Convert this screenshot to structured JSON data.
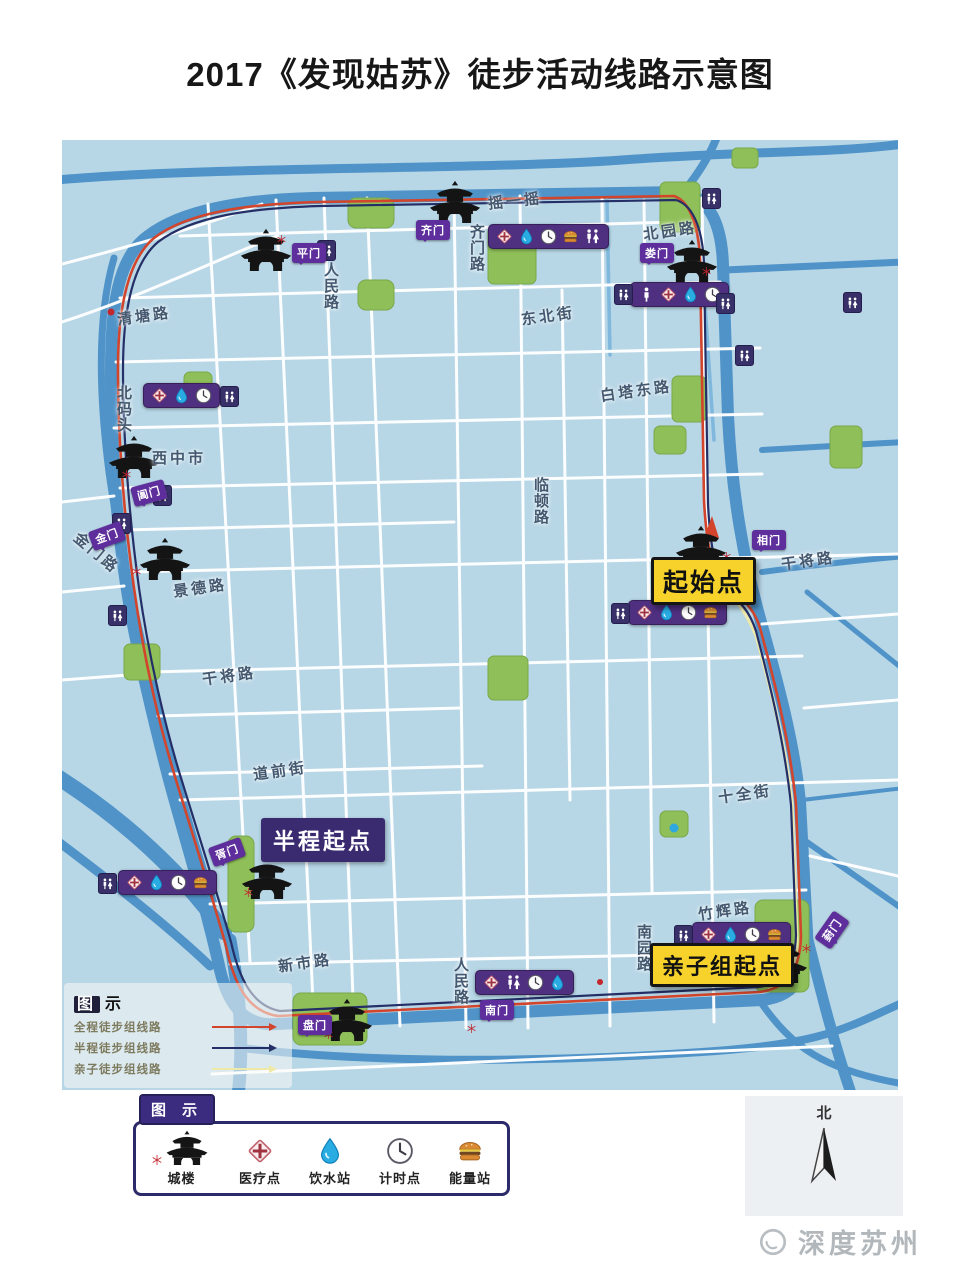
{
  "title": "2017《发现姑苏》徒步活动线路示意图",
  "watermark": "深度苏州",
  "north_label": "北",
  "markers": {
    "start": "起始点",
    "half_start": "半程起点",
    "family_start": "亲子组起点"
  },
  "map_legend": {
    "title_boxed": "图",
    "title_rest": "示",
    "routes": [
      {
        "label": "全程徒步组线路",
        "color": "#d2452c"
      },
      {
        "label": "半程徒步组线路",
        "color": "#232f66"
      },
      {
        "label": "亲子徒步组线路",
        "color": "#efe9a8"
      }
    ]
  },
  "legend": {
    "tab": "图 示",
    "items": [
      {
        "icon": "pagoda",
        "label": "城楼",
        "star": true
      },
      {
        "icon": "medical",
        "label": "医疗点"
      },
      {
        "icon": "water",
        "label": "饮水站"
      },
      {
        "icon": "clock",
        "label": "计时点"
      },
      {
        "icon": "burger",
        "label": "能量站"
      }
    ]
  },
  "colors": {
    "land": "#b7d6e6",
    "river": "#4f93c8",
    "park": "#8fbf58",
    "road": "#ffffff",
    "station_purple": "#4f2f80",
    "gate_purple": "#5e2f9c",
    "route_full": "#d2452c",
    "route_half": "#232f66",
    "route_family": "#efe9a8",
    "marker_yellow": "#f6d22a"
  },
  "map": {
    "roads": [
      {
        "t": "清塘路",
        "x": 55,
        "y": 165,
        "rot": -8
      },
      {
        "t": "北码头",
        "x": 51,
        "y": 245,
        "vert": true
      },
      {
        "t": "西中市",
        "x": 90,
        "y": 307
      },
      {
        "t": "金门路",
        "x": 8,
        "y": 402,
        "rot": 40
      },
      {
        "t": "景德路",
        "x": 111,
        "y": 437,
        "rot": -8
      },
      {
        "t": "干将路",
        "x": 140,
        "y": 525,
        "rot": -8
      },
      {
        "t": "道前街",
        "x": 191,
        "y": 620,
        "rot": -8
      },
      {
        "t": "新市路",
        "x": 216,
        "y": 812,
        "rot": -8
      },
      {
        "t": "人民路",
        "x": 388,
        "y": 817,
        "vert": true
      },
      {
        "t": "人民路",
        "x": 258,
        "y": 122,
        "vert": true
      },
      {
        "t": "齐门路",
        "x": 404,
        "y": 84,
        "vert": true
      },
      {
        "t": "摇一摇",
        "x": 426,
        "y": 50,
        "rot": -6
      },
      {
        "t": "东北街",
        "x": 459,
        "y": 165,
        "rot": -8
      },
      {
        "t": "北园路",
        "x": 581,
        "y": 80,
        "rot": -8
      },
      {
        "t": "白塔东路",
        "x": 538,
        "y": 240,
        "rot": -8
      },
      {
        "t": "临顿路",
        "x": 468,
        "y": 337,
        "vert": true
      },
      {
        "t": "干将路",
        "x": 719,
        "y": 410,
        "rot": -8
      },
      {
        "t": "十全街",
        "x": 656,
        "y": 643,
        "rot": -8
      },
      {
        "t": "竹辉路",
        "x": 636,
        "y": 760,
        "rot": -8
      },
      {
        "t": "南园路",
        "x": 571,
        "y": 784,
        "vert": true
      }
    ],
    "gates": [
      {
        "t": "平门",
        "x": 230,
        "y": 103
      },
      {
        "t": "齐门",
        "x": 354,
        "y": 80
      },
      {
        "t": "娄门",
        "x": 578,
        "y": 103
      },
      {
        "t": "相门",
        "x": 690,
        "y": 390
      },
      {
        "t": "葑门",
        "x": 753,
        "y": 780,
        "rot": -55
      },
      {
        "t": "南门",
        "x": 418,
        "y": 860
      },
      {
        "t": "盘门",
        "x": 236,
        "y": 875
      },
      {
        "t": "胥门",
        "x": 148,
        "y": 702,
        "rot": -20
      },
      {
        "t": "金门",
        "x": 28,
        "y": 386,
        "rot": -20
      },
      {
        "t": "阊门",
        "x": 70,
        "y": 343,
        "rot": -15
      }
    ],
    "stations": [
      {
        "x": 426,
        "y": 84,
        "icons": [
          "medical",
          "water",
          "clock",
          "burger",
          "wc"
        ]
      },
      {
        "x": 568,
        "y": 142,
        "icons": [
          "person",
          "medical",
          "water",
          "clock"
        ]
      },
      {
        "x": 81,
        "y": 243,
        "icons": [
          "medical",
          "water",
          "clock"
        ]
      },
      {
        "x": 56,
        "y": 730,
        "icons": [
          "medical",
          "water",
          "clock",
          "burger"
        ]
      },
      {
        "x": 566,
        "y": 460,
        "icons": [
          "medical",
          "water",
          "clock",
          "burger"
        ]
      },
      {
        "x": 630,
        "y": 782,
        "icons": [
          "medical",
          "water",
          "clock",
          "burger"
        ]
      },
      {
        "x": 413,
        "y": 830,
        "icons": [
          "medical",
          "wc",
          "clock",
          "water"
        ]
      }
    ],
    "toilets": [
      {
        "x": 255,
        "y": 100
      },
      {
        "x": 91,
        "y": 345
      },
      {
        "x": 50,
        "y": 373
      },
      {
        "x": 46,
        "y": 465
      },
      {
        "x": 640,
        "y": 48
      },
      {
        "x": 654,
        "y": 153
      },
      {
        "x": 781,
        "y": 152
      },
      {
        "x": 673,
        "y": 205
      },
      {
        "x": 158,
        "y": 246
      },
      {
        "x": 36,
        "y": 733
      },
      {
        "x": 549,
        "y": 463
      },
      {
        "x": 612,
        "y": 785
      },
      {
        "x": 552,
        "y": 144
      }
    ],
    "pagodas": [
      {
        "cx": 204,
        "cy": 109
      },
      {
        "cx": 393,
        "cy": 61
      },
      {
        "cx": 630,
        "cy": 120
      },
      {
        "cx": 72,
        "cy": 316
      },
      {
        "cx": 103,
        "cy": 418
      },
      {
        "cx": 639,
        "cy": 406
      },
      {
        "cx": 205,
        "cy": 737
      },
      {
        "cx": 285,
        "cy": 879
      },
      {
        "cx": 720,
        "cy": 821
      }
    ],
    "stars": [
      {
        "x": 215,
        "y": 95
      },
      {
        "x": 358,
        "y": 92
      },
      {
        "x": 640,
        "y": 127
      },
      {
        "x": 60,
        "y": 330
      },
      {
        "x": 70,
        "y": 427
      },
      {
        "x": 660,
        "y": 412
      },
      {
        "x": 182,
        "y": 748
      },
      {
        "x": 262,
        "y": 890
      },
      {
        "x": 740,
        "y": 804
      },
      {
        "x": 405,
        "y": 884
      }
    ]
  }
}
